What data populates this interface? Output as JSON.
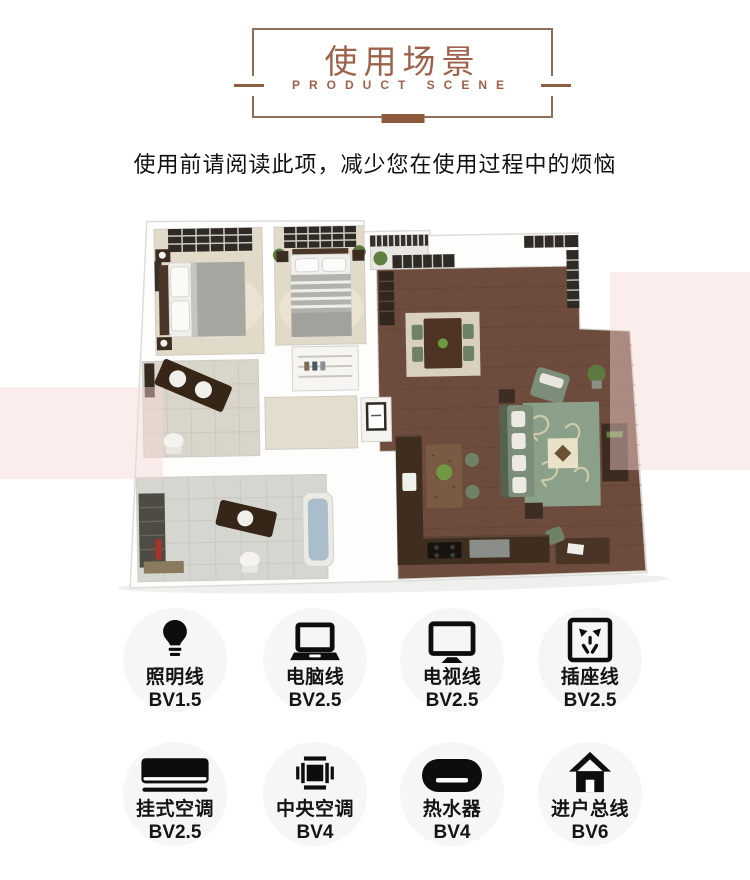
{
  "header": {
    "title": "使用场景",
    "subtitle": "PRODUCT SCENE",
    "accent_color": "#9c624a",
    "border_color": "#8e6e59",
    "bar_color": "#8a5a3b"
  },
  "intro": {
    "text": "使用前请阅读此项，减少您在使用过程中的烦恼"
  },
  "floor_plan": {
    "kind": "3d-apartment-floor-plan-render",
    "palette": {
      "walls": "#ffffff",
      "wood_floor": "#6d4c3e",
      "carpet": "#e1dac9",
      "tile": "#d6d6d1",
      "sofa_green": "#7c8e79",
      "rug_green": "#8ba088",
      "furniture_brown": "#3c2b20",
      "watermark_pink": "#f7d8d4"
    }
  },
  "wires": {
    "rows": [
      [
        {
          "icon": "light-bulb-icon",
          "name": "照明线",
          "spec": "BV1.5"
        },
        {
          "icon": "laptop-icon",
          "name": "电脑线",
          "spec": "BV2.5"
        },
        {
          "icon": "tv-icon",
          "name": "电视线",
          "spec": "BV2.5"
        },
        {
          "icon": "power-socket-icon",
          "name": "插座线",
          "spec": "BV2.5"
        }
      ],
      [
        {
          "icon": "wall-air-conditioner-icon",
          "name": "挂式空调",
          "spec": "BV2.5"
        },
        {
          "icon": "central-air-conditioner-icon",
          "name": "中央空调",
          "spec": "BV4"
        },
        {
          "icon": "water-heater-icon",
          "name": "热水器",
          "spec": "BV4"
        },
        {
          "icon": "house-icon",
          "name": "进户总线",
          "spec": "BV6"
        }
      ]
    ]
  }
}
